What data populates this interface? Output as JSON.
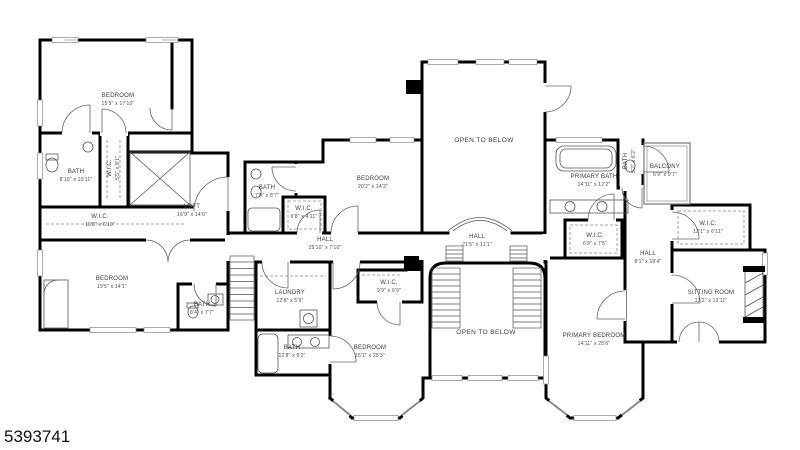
{
  "floorplan": {
    "rooms": [
      {
        "id": "bedroom-1",
        "name": "BEDROOM",
        "dims": "15'9\" x 17'10\""
      },
      {
        "id": "bath-1",
        "name": "BATH",
        "dims": "8'10\" x 10'11\""
      },
      {
        "id": "wic-1",
        "name": "W.I.C.",
        "dims": "5'5\" x 9'1\""
      },
      {
        "id": "wic-2",
        "name": "W.I.C.",
        "dims": "10'8\" x 6'10\""
      },
      {
        "id": "loft",
        "name": "LOFT",
        "dims": "16'9\" x 14'0\""
      },
      {
        "id": "bedroom-2",
        "name": "BEDROOM",
        "dims": "19'5\" x 14'1\""
      },
      {
        "id": "bath-2",
        "name": "BATH",
        "dims": "8'4\" x 7'7\""
      },
      {
        "id": "laundry",
        "name": "LAUNDRY",
        "dims": "12'8\" x 5'9\""
      },
      {
        "id": "bath-3",
        "name": "BATH",
        "dims": "12'8\" x 9'2\""
      },
      {
        "id": "bath-4",
        "name": "BATH",
        "dims": "7'9\" x 8'7\""
      },
      {
        "id": "wic-3",
        "name": "W.I.C.",
        "dims": "6'8\" x 4'11\""
      },
      {
        "id": "bedroom-3",
        "name": "BEDROOM",
        "dims": "20'2\" x 14'3\""
      },
      {
        "id": "hall-1",
        "name": "HALL",
        "dims": "25'10\" x 7'10\""
      },
      {
        "id": "open-below-1",
        "name": "OPEN TO BELOW",
        "dims": ""
      },
      {
        "id": "hall-2",
        "name": "HALL",
        "dims": "21'5\" x 11'1\""
      },
      {
        "id": "wic-4",
        "name": "W.I.C.",
        "dims": "9'9\" x 6'9\""
      },
      {
        "id": "bedroom-4",
        "name": "BEDROOM",
        "dims": "15'1\" x 25'3\""
      },
      {
        "id": "open-below-2",
        "name": "OPEN TO BELOW",
        "dims": ""
      },
      {
        "id": "primary-bath",
        "name": "PRIMARY BATH",
        "dims": "14'11\" x 12'2\""
      },
      {
        "id": "bath-5",
        "name": "BATH",
        "dims": "5'2\" x 6'2\""
      },
      {
        "id": "balcony",
        "name": "BALCONY",
        "dims": "6'9\" x 9'7\""
      },
      {
        "id": "wic-5",
        "name": "W.I.C.",
        "dims": "12'1\" x 6'11\""
      },
      {
        "id": "wic-6",
        "name": "W.I.C.",
        "dims": "6'9\" x 7'5\""
      },
      {
        "id": "hall-3",
        "name": "HALL",
        "dims": "8'1\" x 18'4\""
      },
      {
        "id": "sitting-room",
        "name": "SITTING ROOM",
        "dims": "13'2\" x 13'11\""
      },
      {
        "id": "primary-bedroom",
        "name": "PRIMARY BEDROOM",
        "dims": "14'11\" x 25'6\""
      }
    ],
    "colors": {
      "wall": "#000000",
      "thin_line": "#555555",
      "window": "#8a8a8a",
      "label": "#3b3b3b"
    }
  },
  "footer": {
    "photo_id": "5393741"
  }
}
